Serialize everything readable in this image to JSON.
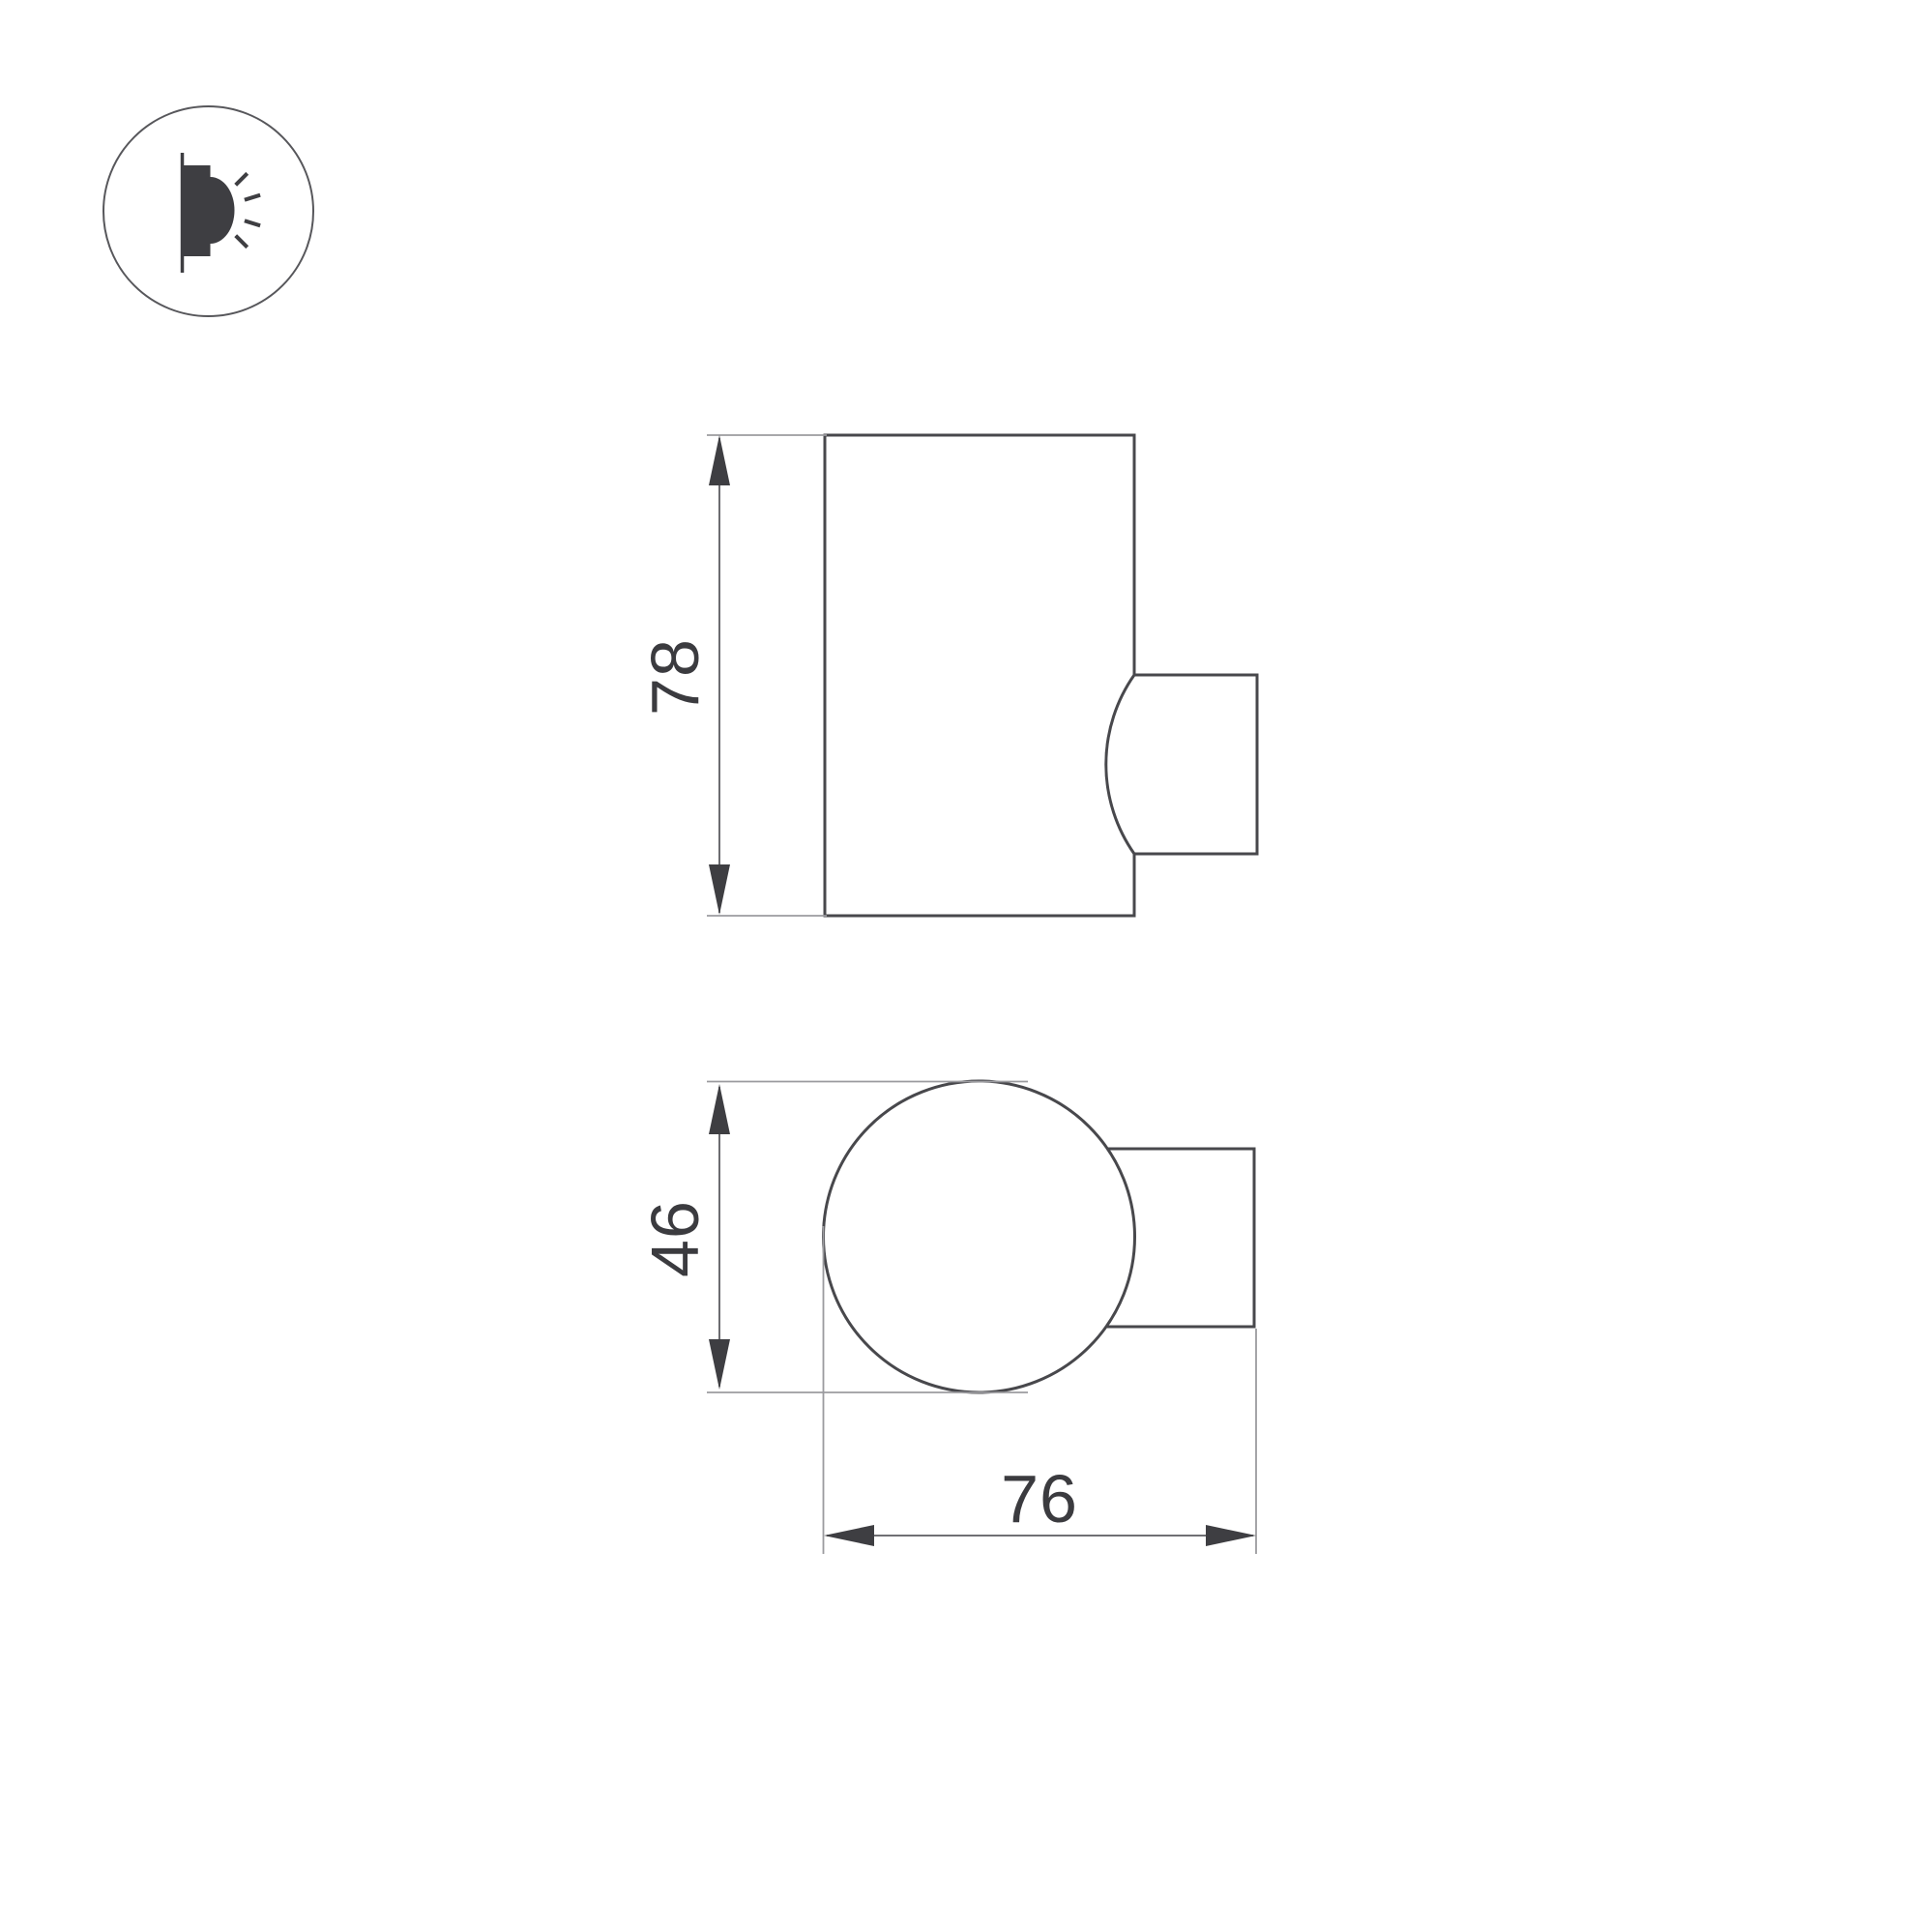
{
  "title": "wall-lamp-dimension-drawing",
  "colors": {
    "bg": "#ffffff",
    "outline": "#48484c",
    "thin-line": "#9b9b9f",
    "dim-line": "#5c5c60",
    "arrow": "#3e3e42",
    "text": "#3b3b3f",
    "icon": "#3e3e42",
    "icon-ring": "#57575b"
  },
  "icon": {
    "name": "wall-light-glow-icon"
  },
  "dimensions": {
    "height": "78",
    "diameter": "46",
    "depth": "76"
  }
}
